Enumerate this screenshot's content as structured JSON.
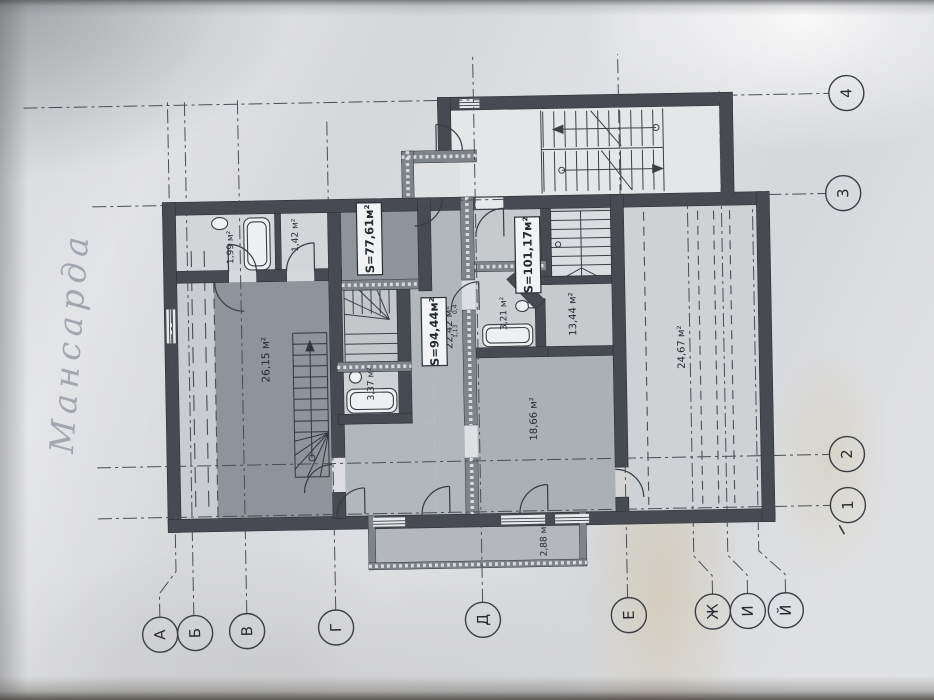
{
  "photo": {
    "handwritten_note": "Мансарда"
  },
  "palette": {
    "paper": "#e0e1e4",
    "ink": "#3a3e44",
    "wall_fill": "#474b51",
    "room_shade_dark": "#8e9499",
    "room_shade_mid": "#b2b7bb",
    "stain": "#c9b97e"
  },
  "plan": {
    "apartments": {
      "left": "S=77,61м²",
      "middle": "S=94,44м²",
      "right": "S=101,17м²"
    },
    "rooms": {
      "hall_left": "26,15 м²",
      "bath_left": "1,99 м²",
      "wc_left": "1,42 м²",
      "bath_middle": "3,37 м²",
      "corridor_middle": "22,42 м²",
      "bath_right": "3,21 м²",
      "room_small_right": "13,44 м²",
      "room_lower_middle": "18,66 м²",
      "room_large_right": "24,67 м²",
      "balcony": "2,88 м²"
    },
    "dimensions": {
      "d1": "0,4",
      "d2": "1,13"
    },
    "axes": {
      "letters": [
        "А",
        "Б",
        "В",
        "Г",
        "Д",
        "Е",
        "Ж",
        "И",
        "Й"
      ],
      "numbers": [
        "4",
        "3",
        "2",
        "1"
      ]
    }
  }
}
